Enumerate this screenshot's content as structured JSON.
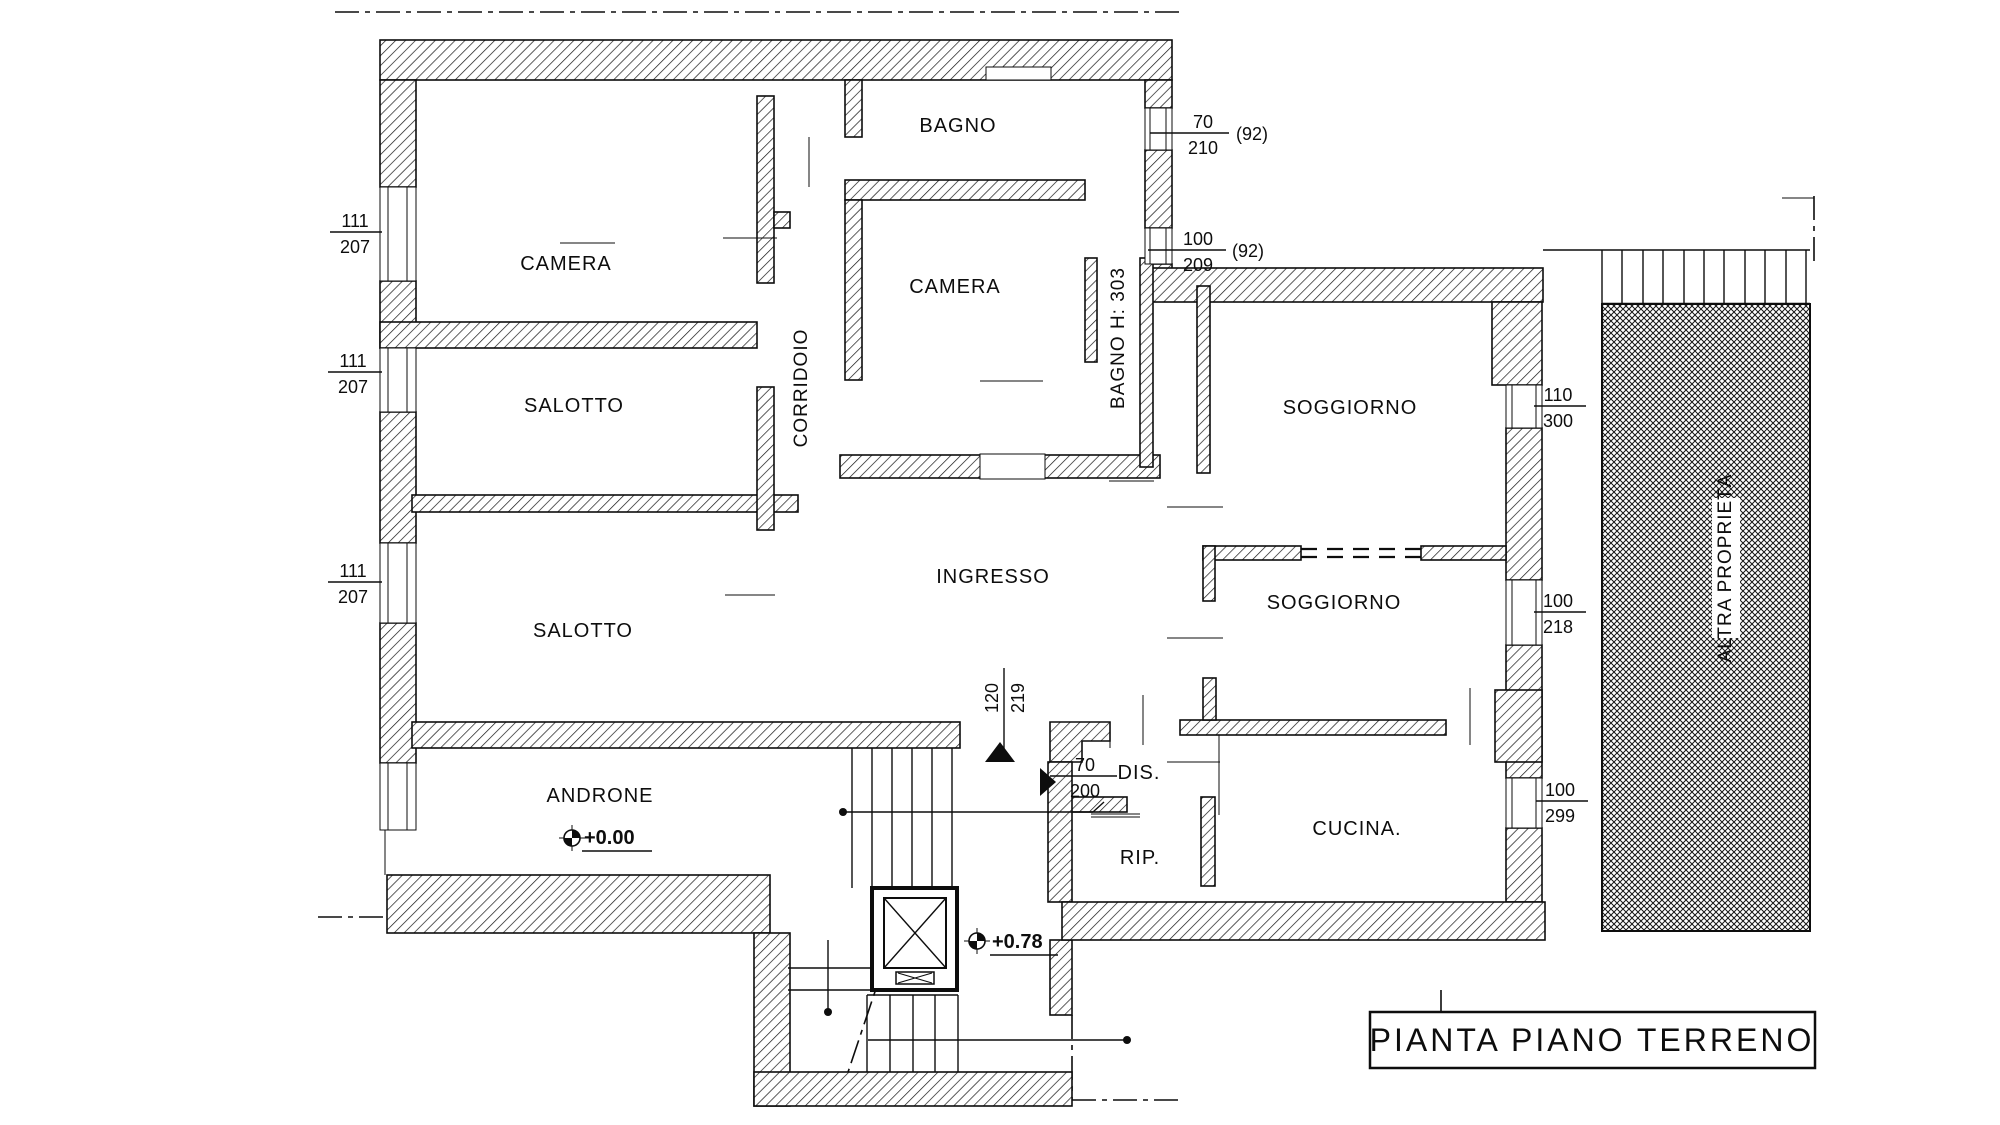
{
  "page": {
    "background": "#ffffff",
    "ink": "#0d0d0d"
  },
  "plan": {
    "title": "PIANTA PIANO TERRENO",
    "rooms": {
      "camera1": "CAMERA",
      "bagno1": "BAGNO",
      "camera2": "CAMERA",
      "corridoio": "CORRIDOIO",
      "salotto1": "SALOTTO",
      "salotto2": "SALOTTO",
      "ingresso": "INGRESSO",
      "bagno2": "BAGNO  H: 303",
      "soggiorno1": "SOGGIORNO",
      "soggiorno2": "SOGGIORNO",
      "androne": "ANDRONE",
      "dis": "DIS.",
      "rip": "RIP.",
      "cucina": "CUCINA.",
      "altra_proprieta": "ALTRA PROPRIETÀ"
    },
    "elevations": {
      "androne": "+0.00",
      "stairwell": "+0.78"
    },
    "dimensions": {
      "d1": {
        "num": "111",
        "den": "207"
      },
      "d2": {
        "num": "111",
        "den": "207"
      },
      "d3": {
        "num": "111",
        "den": "207"
      },
      "d4": {
        "num": "70",
        "den": "210",
        "note": "(92)"
      },
      "d5": {
        "num": "100",
        "den": "209",
        "note": "(92)"
      },
      "d6": {
        "num": "110",
        "den": "300"
      },
      "d7": {
        "num": "100",
        "den": "218"
      },
      "d8": {
        "num": "100",
        "den": "299"
      },
      "d9": {
        "num": "120",
        "den": "219"
      },
      "d10": {
        "num": "70",
        "den": "200"
      }
    }
  }
}
